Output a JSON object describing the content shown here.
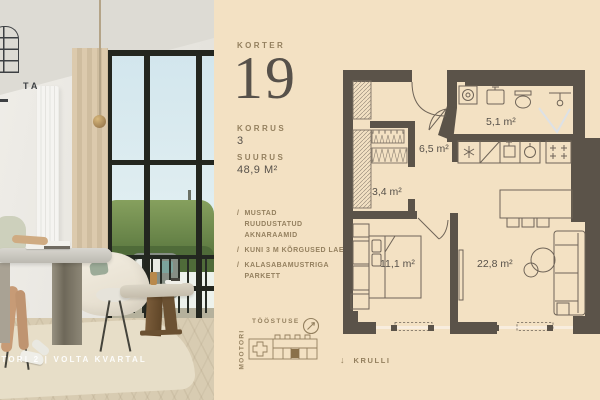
{
  "brand": {
    "logo_text": "TA",
    "caption": "OTORI 2   |   VOLTA KVARTAL"
  },
  "unit": {
    "korter_label": "KORTER",
    "number": "19",
    "korrus_label": "KORRUS",
    "korrus_value": "3",
    "suurus_label": "SUURUS",
    "suurus_value": "48,9 M²"
  },
  "features": [
    {
      "prefix": "/",
      "lines": [
        "MUSTAD",
        "RUUDUSTATUD",
        "AKNARAAMID"
      ]
    },
    {
      "prefix": "/",
      "lines": [
        "KUNI 3 M KÕRGUSED LAED"
      ]
    },
    {
      "prefix": "/",
      "lines": [
        "KALASABAMUSTRIGA",
        "PARKETT"
      ]
    }
  ],
  "floorplan": {
    "rooms": [
      {
        "name": "hallway",
        "area": "6,5 m²"
      },
      {
        "name": "bathroom",
        "area": "5,1 m²"
      },
      {
        "name": "wardrobe",
        "area": "3,4 m²"
      },
      {
        "name": "bedroom",
        "area": "11,1 m²"
      },
      {
        "name": "living-room",
        "area": "22,8 m²"
      }
    ]
  },
  "sitemap": {
    "street_top": "TÖÖSTUSE",
    "street_left": "MOOTORI",
    "street_bottom_arrow": "↓",
    "street_bottom": "KRULLI"
  },
  "colors": {
    "panel_bg": "#f3e1c3",
    "wall": "#5b5349",
    "accent": "#94805f",
    "ink": "#57514a"
  }
}
